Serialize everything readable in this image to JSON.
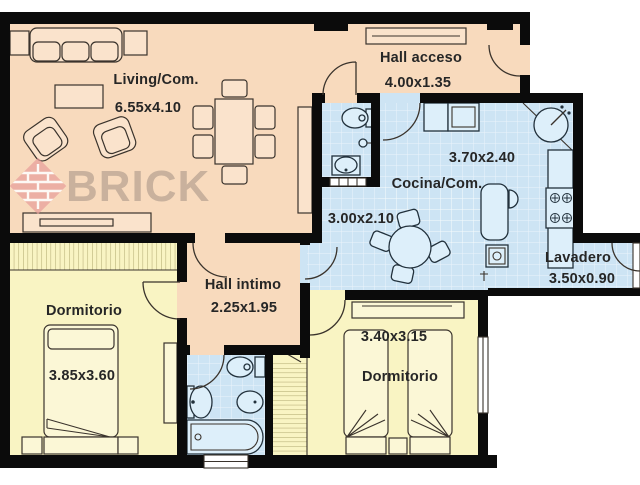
{
  "watermark": {
    "text": "BRICK"
  },
  "rooms": {
    "living": {
      "name": "Living/Com.",
      "dims": "6.55x4.10"
    },
    "hall_acceso": {
      "name": "Hall acceso",
      "dims": "4.00x1.35"
    },
    "cocina": {
      "name": "Cocina/Com.",
      "dims_main": "3.70x2.40",
      "dims_left": "3.00x2.10"
    },
    "lavadero": {
      "name": "Lavadero",
      "dims": "3.50x0.90"
    },
    "hall_intimo": {
      "name": "Hall intimo",
      "dims": "2.25x1.95"
    },
    "dormitorio_1": {
      "name": "Dormitorio",
      "dims": "3.85x3.60"
    },
    "dormitorio_2": {
      "name": "Dormitorio",
      "dims": "3.40x3.15"
    }
  },
  "colors": {
    "wall": "#0b0b0b",
    "peach": "#f8dabd",
    "blue": "#cde4f4",
    "yellow": "#f9f4c3",
    "furn_peach": "#fae3cc",
    "furn_yellow": "#fbf7d6",
    "fixture_fill": "#ddeffa",
    "fixture_line": "#22313c",
    "line": "#3a332c",
    "text": "#262626",
    "wm_text": "#8a7d74",
    "wm_pink": "#e89f9b"
  }
}
